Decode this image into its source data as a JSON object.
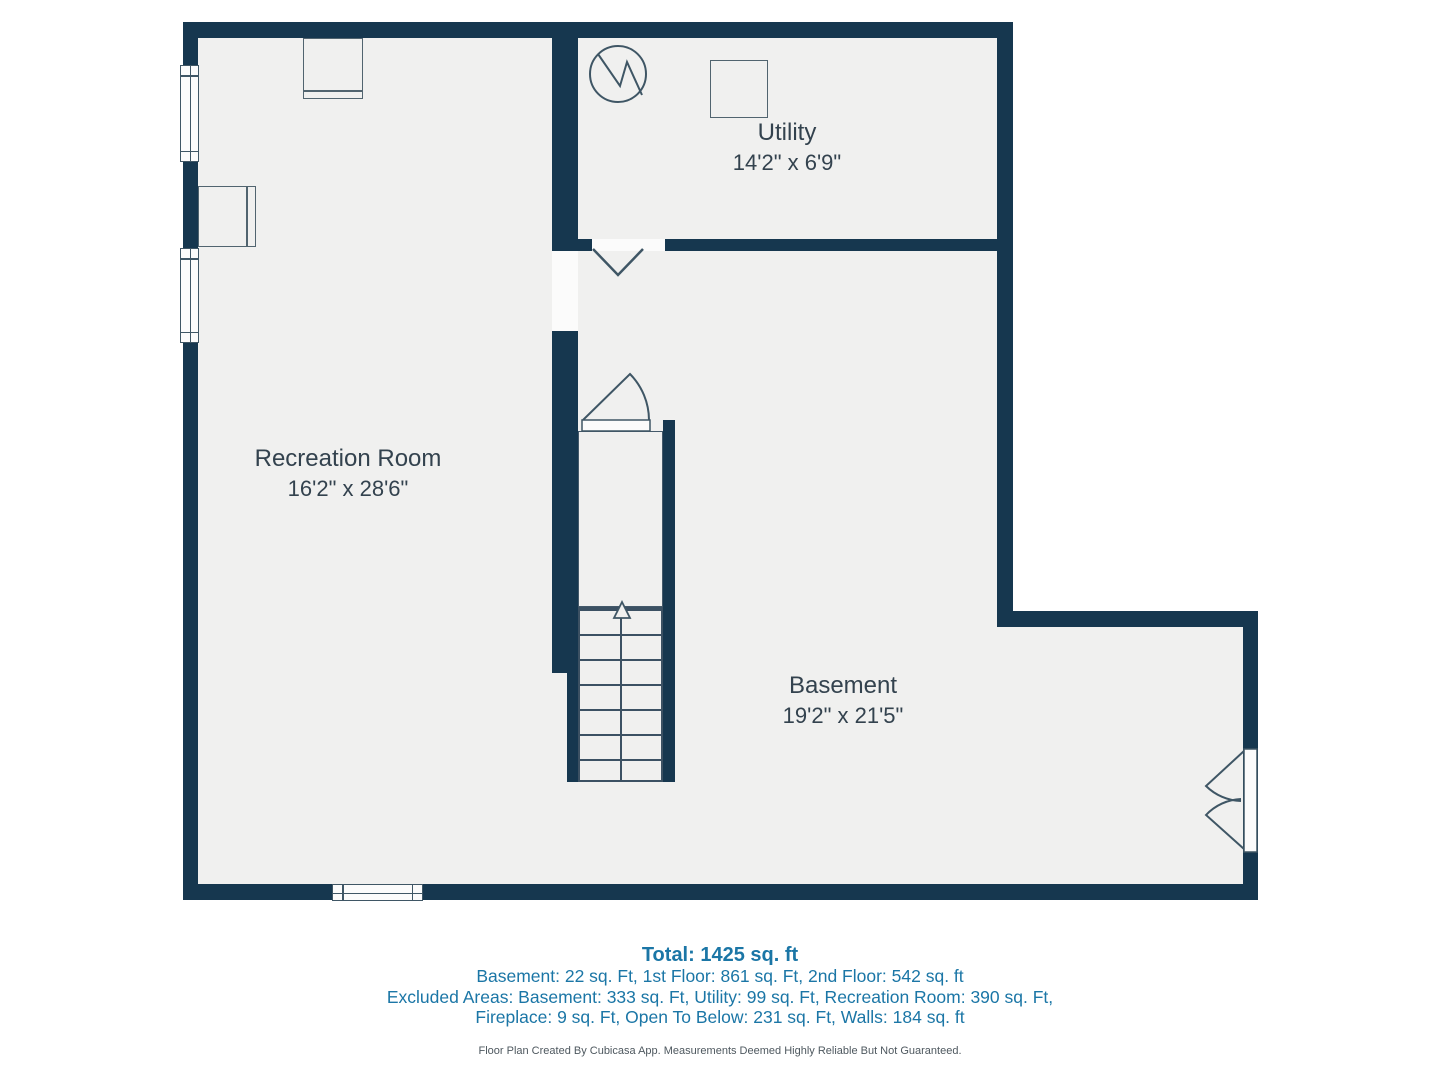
{
  "plan": {
    "rooms": [
      {
        "id": "utility",
        "name": "Utility",
        "dims": "14'2\" x 6'9\""
      },
      {
        "id": "recreation",
        "name": "Recreation Room",
        "dims": "16'2\" x 28'6\""
      },
      {
        "id": "basement",
        "name": "Basement",
        "dims": "19'2\" x 21'5\""
      }
    ],
    "icons": [
      {
        "name": "water-heater-icon",
        "shape": "circle-with-zigzag"
      },
      {
        "name": "appliance-icon",
        "shape": "square-outline"
      },
      {
        "name": "fireplace-top-icon",
        "shape": "box-with-hearth-plate"
      },
      {
        "name": "fireplace-left-icon",
        "shape": "box-with-hearth-plate"
      },
      {
        "name": "stairs-icon",
        "shape": "treads-with-up-arrow"
      },
      {
        "name": "door-swing-icon",
        "shape": "quarter-arc"
      },
      {
        "name": "double-door-icon",
        "shape": "two-arcs"
      },
      {
        "name": "bifold-door-icon",
        "shape": "v-lines"
      },
      {
        "name": "window-icon",
        "shape": "white-bar-with-lines"
      }
    ],
    "colors": {
      "wall": "#16374f",
      "floor": "#f0f0ef",
      "stroke": "#3f5665",
      "room_label": "#33424e",
      "footer_accent": "#1b76a6",
      "disclaimer": "#4e585f",
      "background": "#ffffff"
    }
  },
  "footer": {
    "total": "Total: 1425 sq. ft",
    "floors": "Basement: 22 sq. Ft, 1st Floor: 861 sq. Ft, 2nd Floor: 542 sq. ft",
    "excluded_1": "Excluded Areas: Basement: 333 sq. Ft, Utility: 99 sq. Ft, Recreation Room: 390 sq. Ft,",
    "excluded_2": "Fireplace: 9 sq. Ft, Open To Below: 231 sq. Ft, Walls: 184 sq. ft",
    "disclaimer": "Floor Plan Created By Cubicasa App. Measurements Deemed Highly Reliable But Not Guaranteed."
  }
}
